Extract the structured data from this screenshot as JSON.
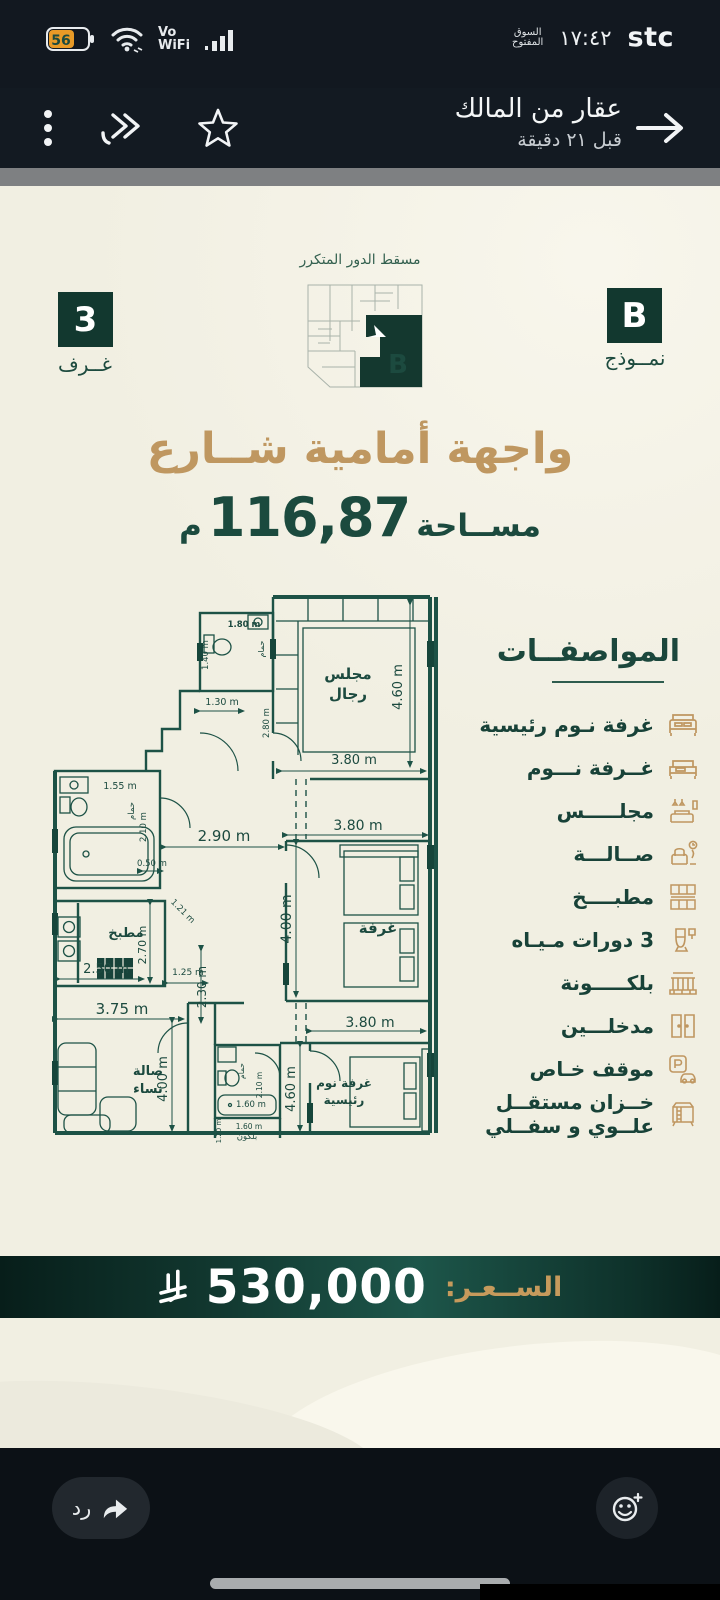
{
  "status": {
    "battery": "56",
    "vo": "Vo",
    "wifi": "WiFi",
    "logo_line1": "السوق",
    "logo_line2": "المفتوح",
    "time": "١٧:٤٢",
    "operator": "stc"
  },
  "header": {
    "title": "عقار من المالك",
    "subtitle": "قبل ٢١ دقيقة"
  },
  "poster": {
    "thumb_caption": "مسقط الدور المتكرر",
    "thumb_letter": "B",
    "badge_rooms_value": "3",
    "badge_rooms_label": "غــرف",
    "badge_model_value": "B",
    "badge_model_label": "نمــوذج",
    "headline": "واجهة أمامية شــارع",
    "area_word": "مســاحة",
    "area_value": "116,87",
    "area_unit": "م"
  },
  "floorplan": {
    "rooms": {
      "majlis_l1": "مجلس",
      "majlis_l2": "رجال",
      "bedroom": "غرفة",
      "master_l1": "غرفة نوم",
      "master_l2": "رئيسية",
      "salla_l1": "صالة",
      "salla_l2": "نساء",
      "kitchen": "مطبخ",
      "bath": "حمام",
      "balcony": "بلكون"
    },
    "dims": {
      "d180": "1.80 m",
      "d140": "1.40 m",
      "d130": "1.30 m",
      "d280": "2.80 m",
      "d380": "3.80 m",
      "d460": "4.60 m",
      "d290": "2.90 m",
      "d155": "1.55 m",
      "d210": "2.10 m",
      "d050": "0.50 m",
      "d121": "1.21 m",
      "d400": "4.00 m",
      "d250": "2.50 m",
      "d270": "2.70 m",
      "d125": "1.25 m",
      "d230": "2.30 m",
      "d375": "3.75 m",
      "d160": "1.60 m",
      "d120": "1.20 m"
    }
  },
  "specs": {
    "title": "المواصفــات",
    "items": [
      {
        "label": "غرفة نـوم رئيسية",
        "icon": "bed-large"
      },
      {
        "label": "غــرفة نـــوم",
        "icon": "bed"
      },
      {
        "label": "مجلـــــس",
        "icon": "sofa"
      },
      {
        "label": "صــالـــة",
        "icon": "armchair"
      },
      {
        "label": "مطبــــخ",
        "icon": "kitchen"
      },
      {
        "label": "3 دورات مـيـاه",
        "icon": "toilet"
      },
      {
        "label": "بلكـــــونة",
        "icon": "balcony"
      },
      {
        "label": "مدخلـــين",
        "icon": "doors"
      },
      {
        "label": "موقف خـاص",
        "icon": "parking"
      },
      {
        "label": "خــزان مستقــل علــوي و سفــلي",
        "icon": "tank"
      }
    ]
  },
  "price": {
    "label": "الســعـر:",
    "value": "530,000"
  },
  "bottom": {
    "reply_label": "رد"
  }
}
